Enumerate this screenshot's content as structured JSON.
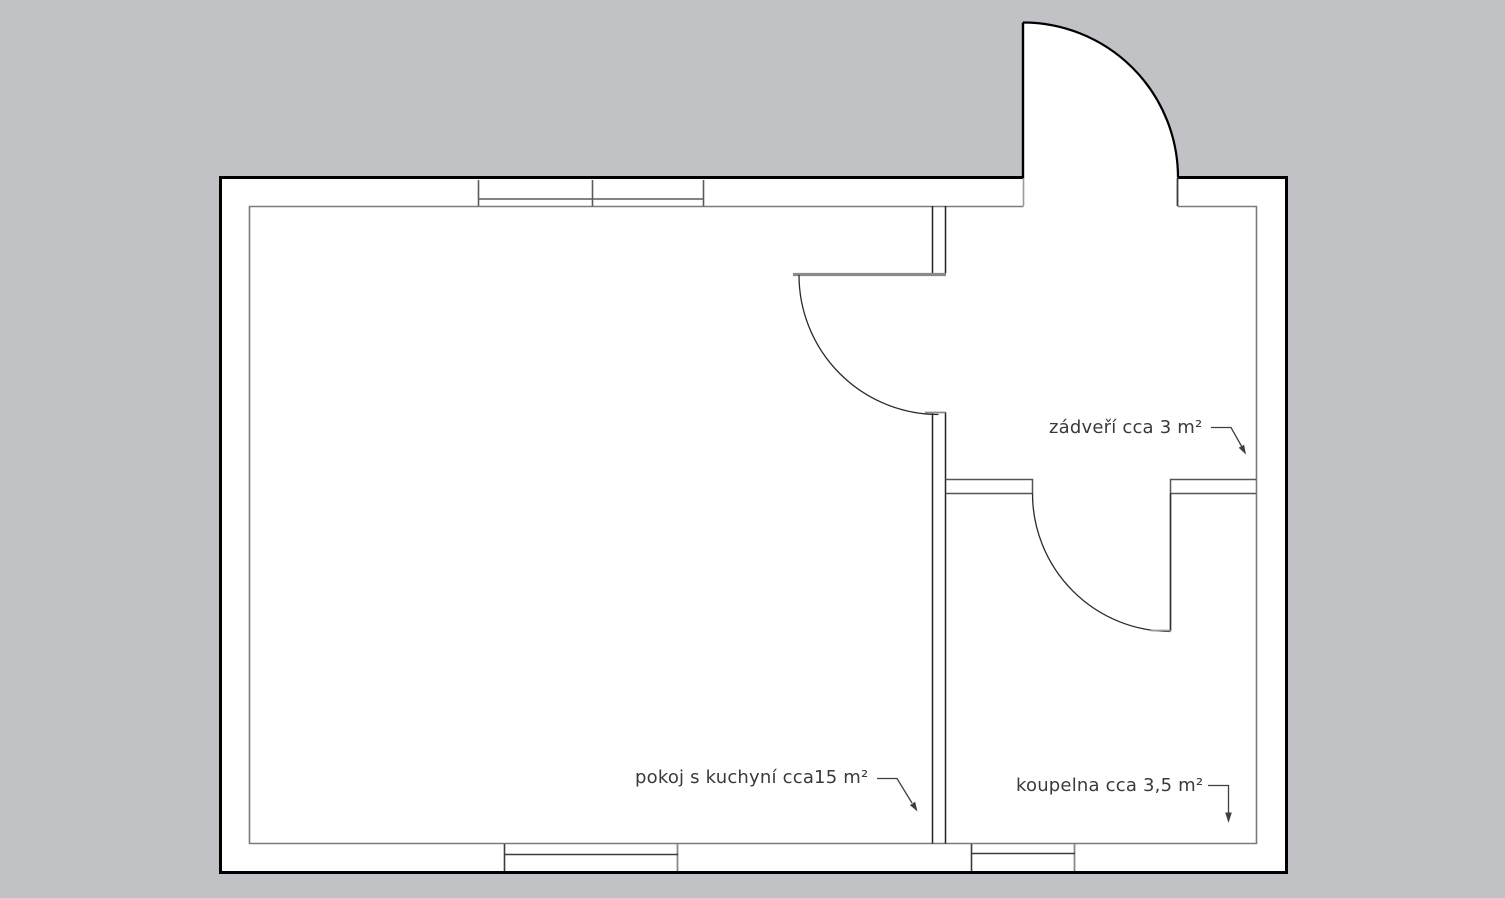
{
  "colors": {
    "background": "#c1c2c6",
    "plan_fill": "#ffffff",
    "outer_wall": "#000000",
    "inner_wall": "#7b7b7b",
    "window_line": "#5a5a5a",
    "door_leaf": "#8a8a8a",
    "leader_line": "#3f3f3f",
    "label_text": "#3a3a3a"
  },
  "rooms": [
    {
      "label": "zádveří cca 3 m²"
    },
    {
      "label": "pokoj s kuchyní cca15 m²"
    },
    {
      "label": "koupelna cca 3,5 m²"
    }
  ]
}
